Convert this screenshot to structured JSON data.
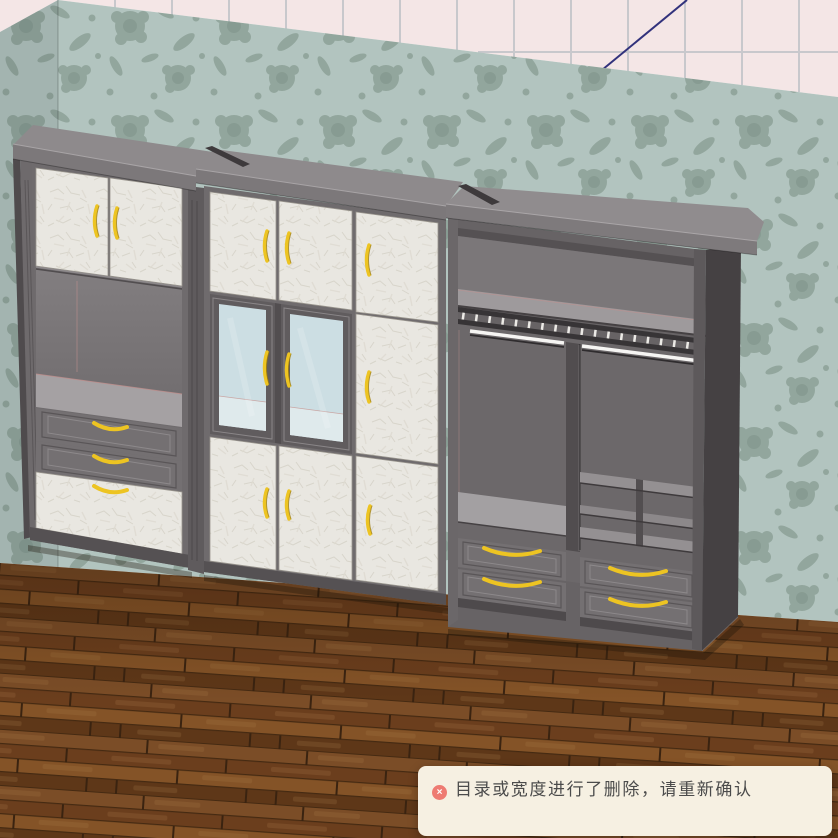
{
  "scene": {
    "type": "3d-room-furniture-preview",
    "room": {
      "ceiling_color": "#f4e6e6",
      "ceiling_grid_color": "#c8c8cc",
      "ceiling_corner_line_color": "#32327c",
      "wallpaper_base": "#b2c4bf",
      "wallpaper_motif": "#92a69d",
      "floor_wood_base": "#6f431f"
    },
    "furniture": {
      "label": "wardrobe-cabinet-wall-unit",
      "frame_color": "#6f6b6d",
      "door_panel_color": "#e9e7e1",
      "glass_color": "#ccdee3",
      "handle_color": "#edc422",
      "interior_color": "#6e6a6c",
      "sections": [
        {
          "name": "left-hutch",
          "features": "two doors, open shelf, two drawers, bottom drawer"
        },
        {
          "name": "center-display-cabinet",
          "features": "upper doors, two glass display doors, lower doors"
        },
        {
          "name": "right-open-wardrobe",
          "features": "top shelf, lighted hanging rail, cubbies, four drawers"
        }
      ]
    }
  },
  "toast": {
    "message": "目录或宽度进行了删除，请重新确认",
    "icon_glyph": "×",
    "icon_color": "#ee7b72",
    "background": "#f6f0e2",
    "text_color": "#4b4b4b"
  }
}
